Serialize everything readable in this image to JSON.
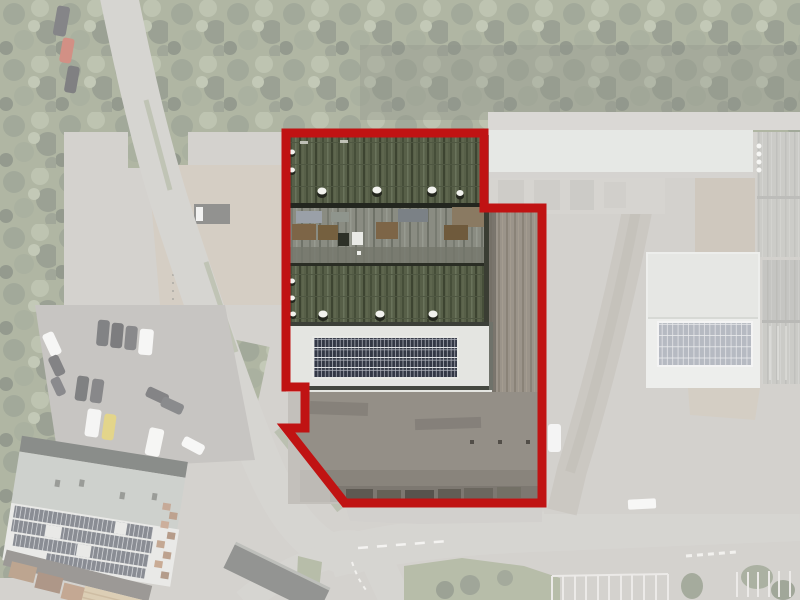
{
  "scene": {
    "type": "aerial-site-plan",
    "description": "Faded aerial photograph of an industrial estate; a thick red outline highlights a warehouse property with mossy corrugated roofs, a white roof section with a solar panel array, and a concrete yard.",
    "width": 800,
    "height": 600
  },
  "boundary": {
    "points": "286,133 484,133 484,208 542,208 542,503 345,503 286,428 305,428 305,387 286,387",
    "color": "#c01313",
    "stroke_width": 9
  },
  "fade": {
    "color": "#ffffff",
    "opacity": 0.44
  },
  "palette": {
    "ground": "#b3afa8",
    "tree_canopy": "#727d5c",
    "road": "#b7b4ae",
    "gravel": "#b4a896",
    "roof_dark_green": "#575f48",
    "roof_gray": "#8a8c82",
    "roof_white": "#e4e5e1",
    "solar_panel": "#333845",
    "concrete_yard": "#948f87",
    "red_car": "#b03a26",
    "yellow_car": "#cdb42e"
  }
}
